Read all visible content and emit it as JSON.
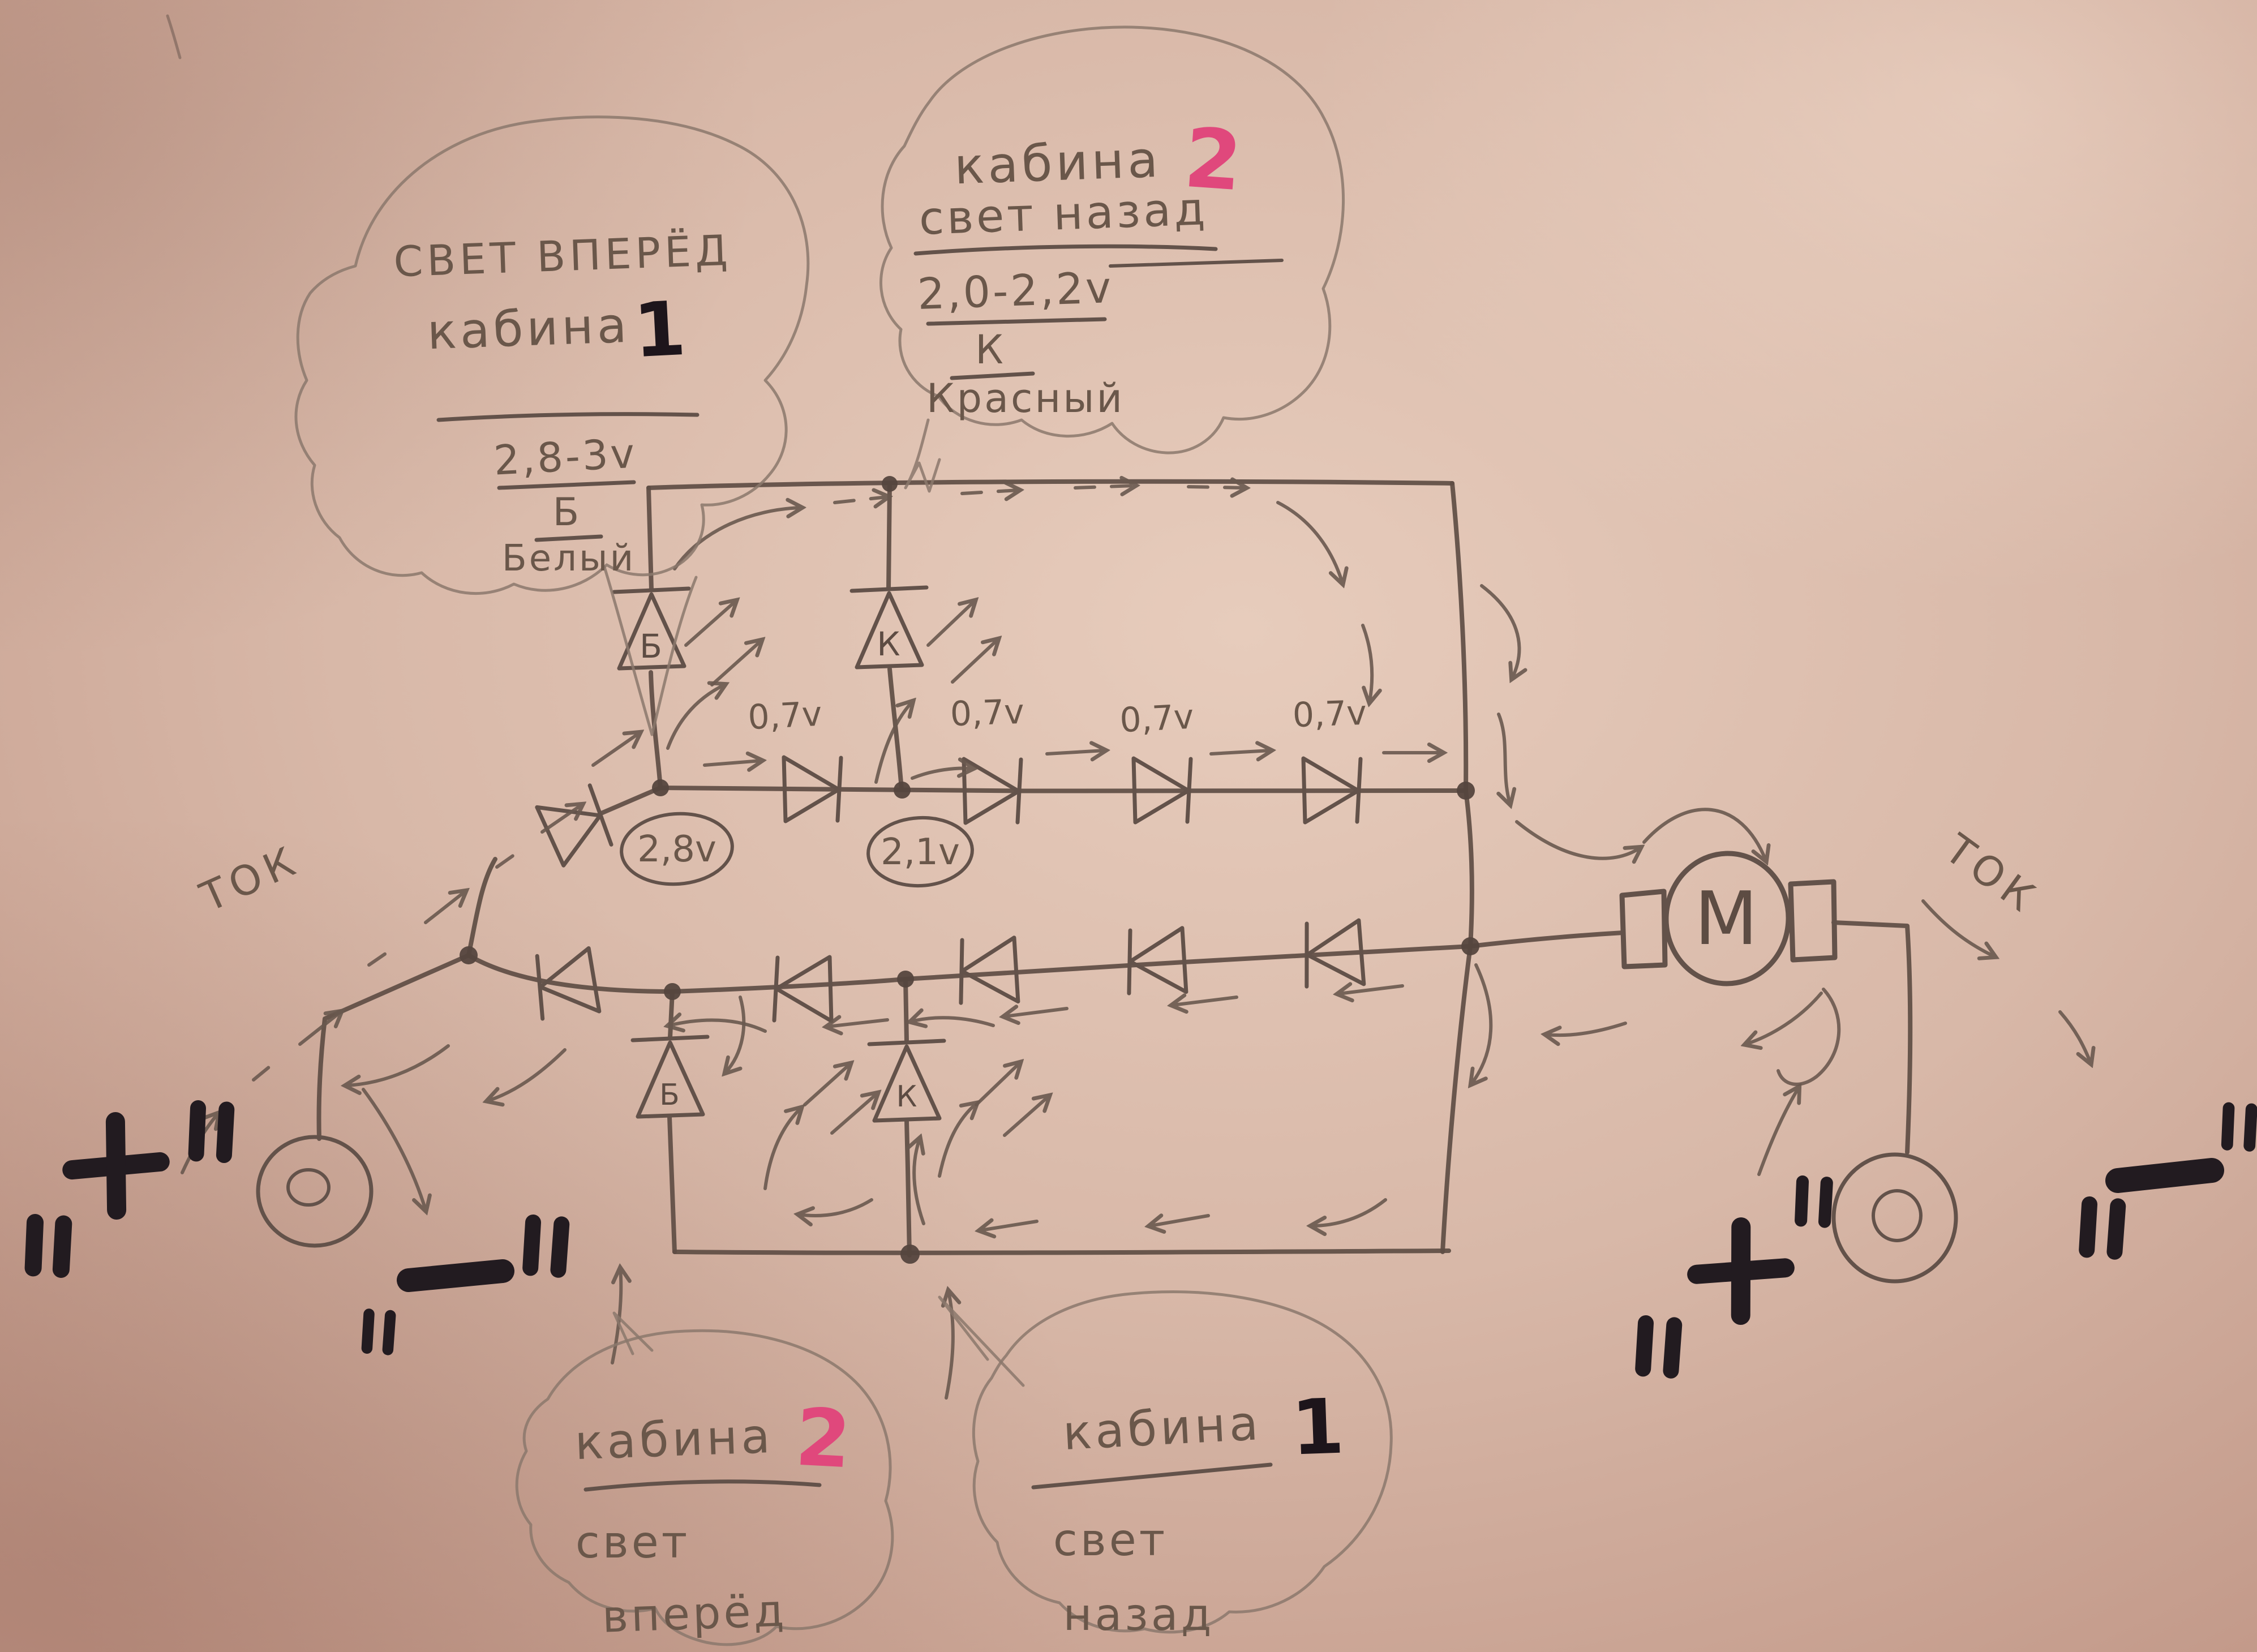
{
  "note_labels": {
    "bubble_top_left": {
      "title": "СВЕТ ВПЕРЁД",
      "cab_word": "кабина",
      "cab_num": "1",
      "voltage_range": "2,8-3v",
      "wire_letter": "Б",
      "wire_color": "Белый"
    },
    "bubble_top_middle": {
      "cab_word": "кабина",
      "cab_num": "2",
      "title": "свет назад",
      "voltage_range": "2,0-2,2v",
      "wire_letter": "К",
      "wire_color": "Красный"
    },
    "bubble_bottom_left": {
      "cab_word": "кабина",
      "cab_num": "2",
      "line1": "свет",
      "line2": "вперёд"
    },
    "bubble_bottom_right": {
      "cab_word": "кабина",
      "cab_num": "1",
      "line1": "свет",
      "line2": "назад"
    }
  },
  "circuit": {
    "motor_label": "M",
    "current_label": "ТОК",
    "node_voltage_left": "2,8v",
    "node_voltage_right": "2,1v",
    "diode_drops": [
      "0,7v",
      "0,7v",
      "0,7v",
      "0,7v"
    ],
    "top_led_letters": {
      "white": "Б",
      "red": "К"
    },
    "bottom_led_letters": {
      "white": "Б",
      "red": "К"
    },
    "polarity": {
      "plus": "+",
      "minus": "−",
      "quote": "\""
    }
  },
  "colors": {
    "paper": "#d9b9aa",
    "pencil": "#6a594f",
    "marker_black": "#221b20",
    "marker_pink": "#e0487c"
  }
}
